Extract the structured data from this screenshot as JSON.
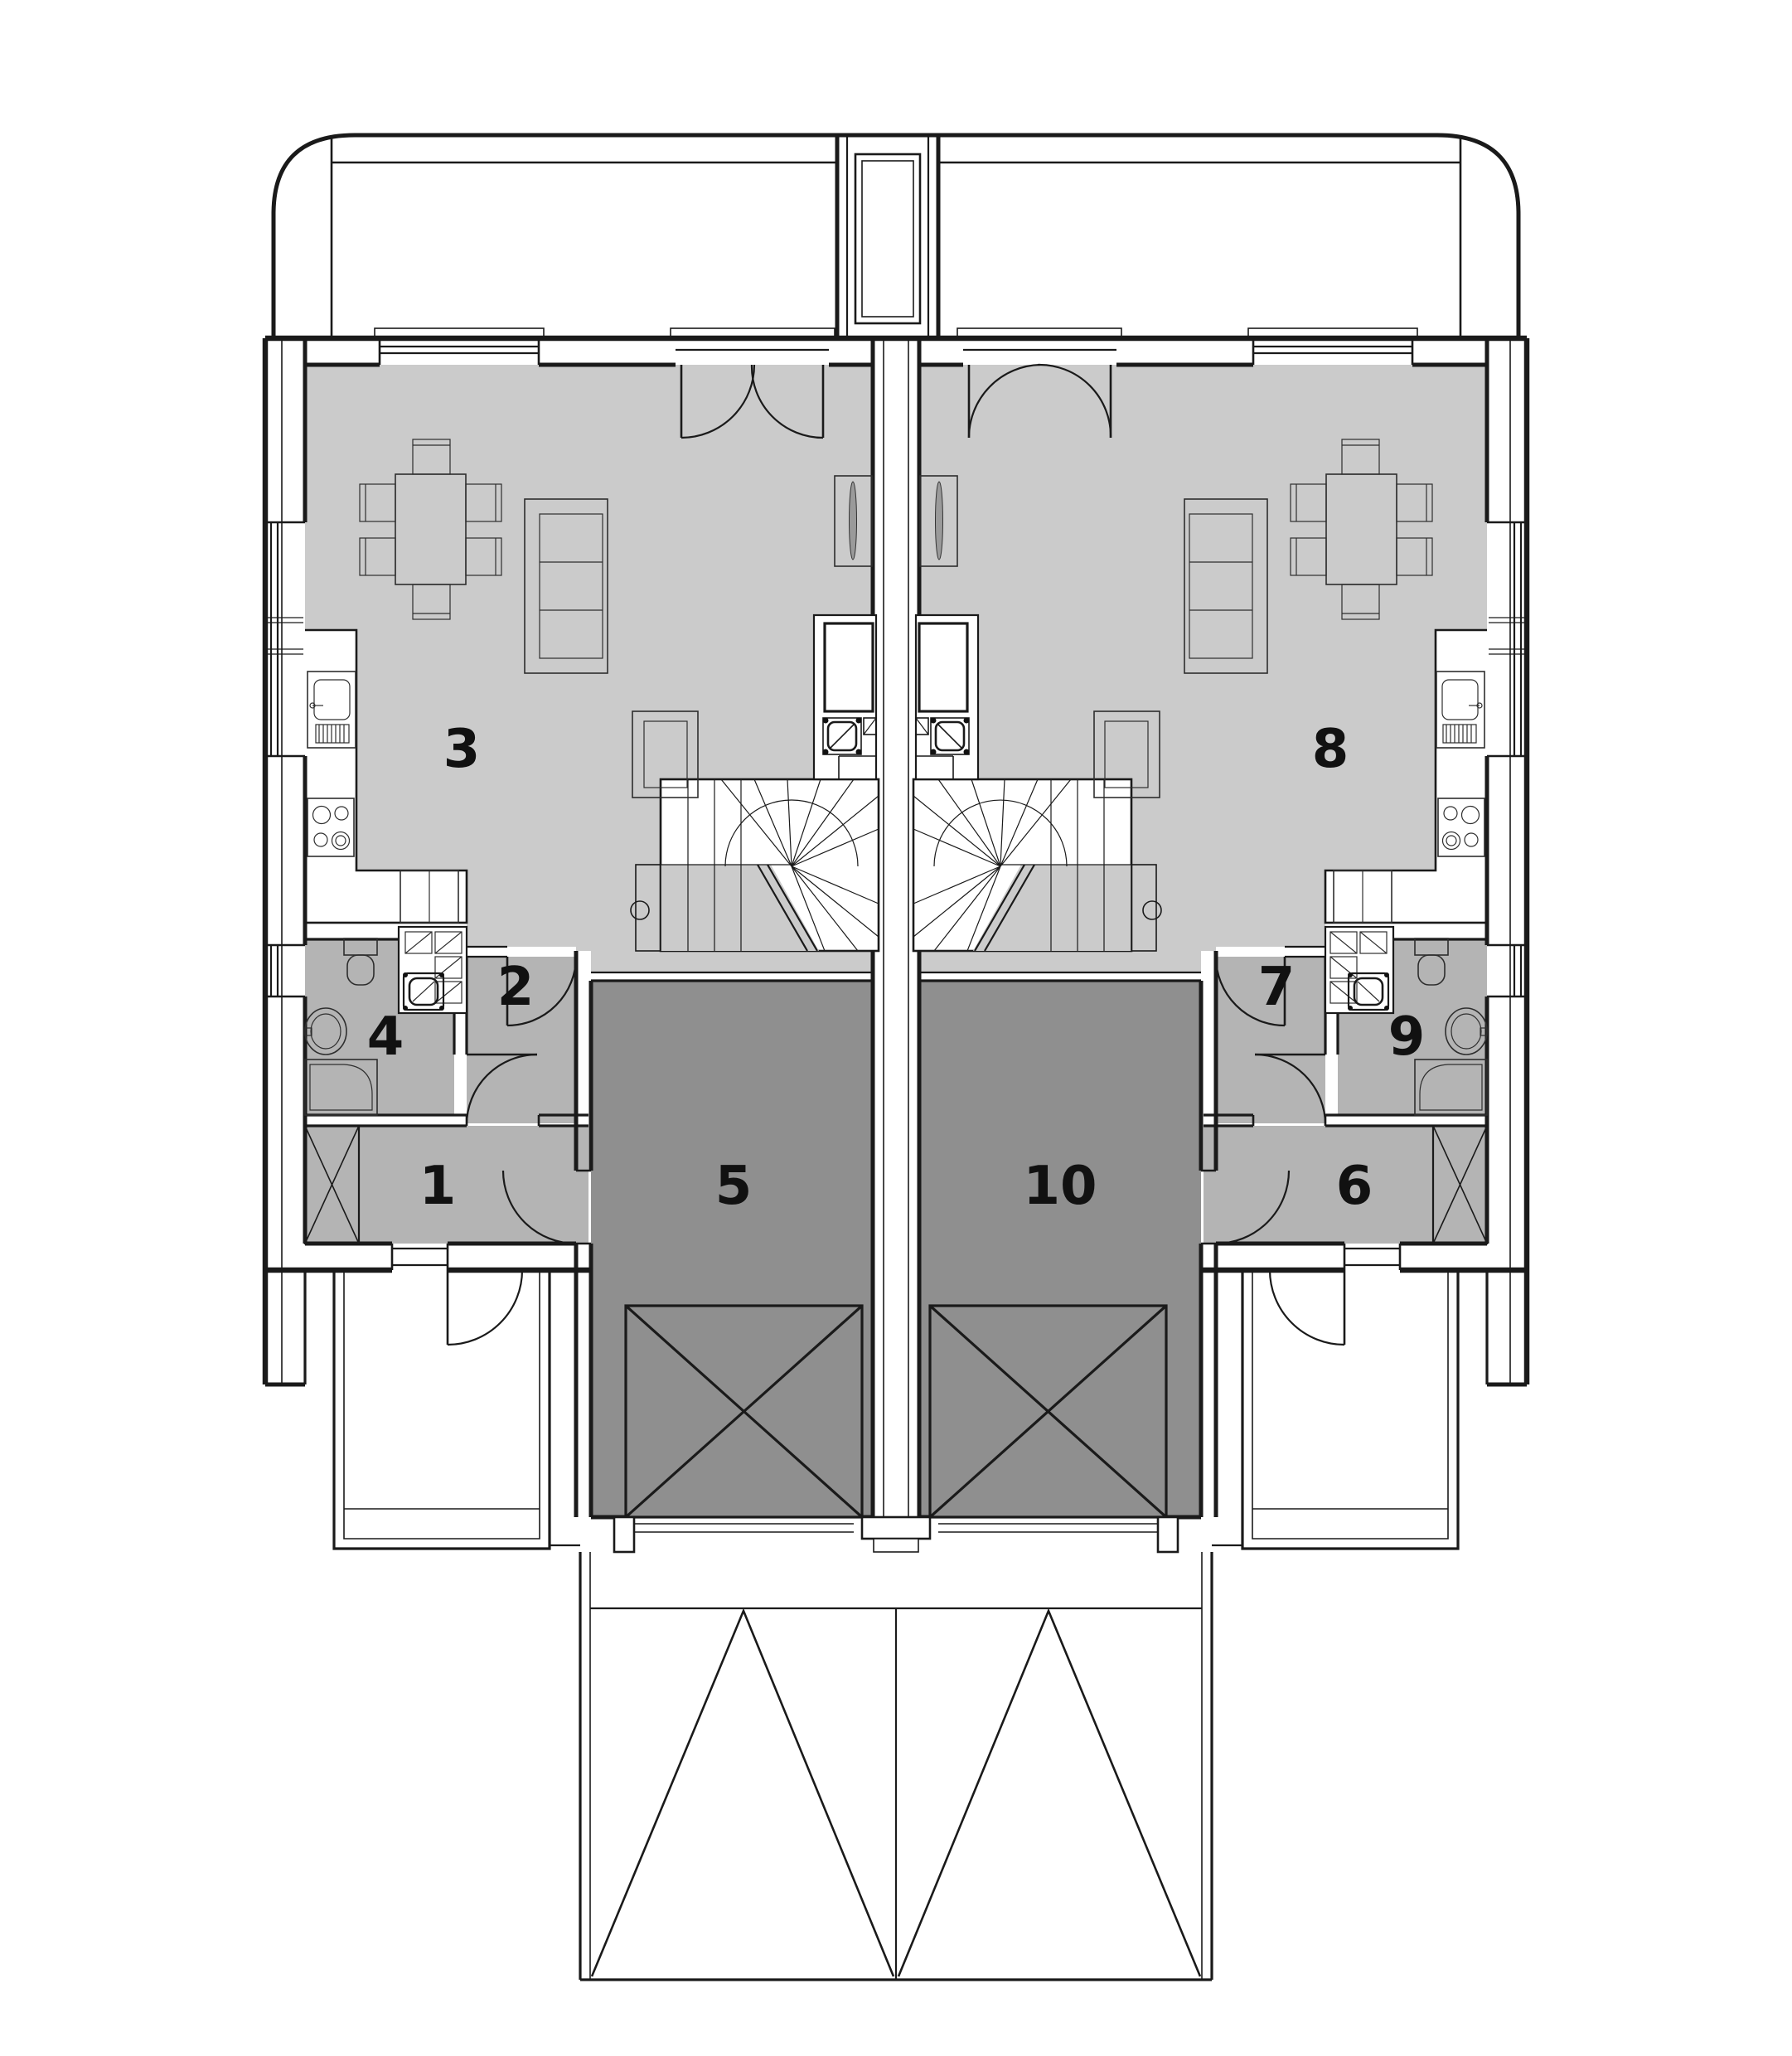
{
  "plan": {
    "kind": "floor-plan",
    "layout": "two mirrored dwelling units",
    "background": "#ffffff"
  },
  "colors": {
    "living_area": "#cbcbcb",
    "secondary_rooms": "#b4b4b4",
    "garage": "#8f8f8f",
    "walls": "#1a1a1a",
    "label": "#111111",
    "tv": "#9a9a9a"
  },
  "rooms": {
    "r1": {
      "label": "1"
    },
    "r2": {
      "label": "2"
    },
    "r3": {
      "label": "3"
    },
    "r4": {
      "label": "4"
    },
    "r5": {
      "label": "5"
    },
    "r6": {
      "label": "6"
    },
    "r7": {
      "label": "7"
    },
    "r8": {
      "label": "8"
    },
    "r9": {
      "label": "9"
    },
    "r10": {
      "label": "10"
    }
  }
}
